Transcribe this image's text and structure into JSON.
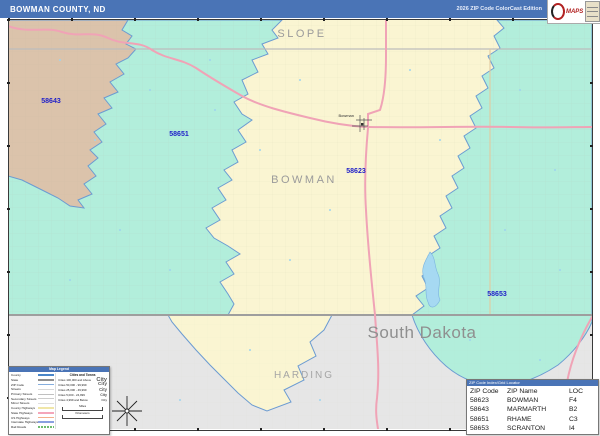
{
  "header": {
    "title": "BOWMAN COUNTY, ND",
    "edition": "2026 ZIP Code ColorCast Edition"
  },
  "logo": {
    "maps_text": "MAPS"
  },
  "map": {
    "labels": {
      "county_top": "SLOPE",
      "county_main": "BOWMAN",
      "county_bottom": "HARDING",
      "state": "South Dakota",
      "town": "Bowman"
    },
    "zip_labels": {
      "marmarth": "58643",
      "rhame": "58651",
      "bowman": "58623",
      "scranton": "58653"
    }
  },
  "legend": {
    "title": "Map Legend",
    "line_items": [
      "County",
      "State",
      "ZIP Code",
      "Streets",
      "Primary Streets",
      "Secondary Streets",
      "Minor Streets",
      "County Highways",
      "State Highways",
      "US Highways",
      "Interstate Highways",
      "Rail Roads"
    ],
    "cities_title": "Cities and Towns",
    "city_items": [
      {
        "label": "Cities 100,000 and Above",
        "sample": "City"
      },
      {
        "label": "Cities 50,000 - 99,999",
        "sample": "City"
      },
      {
        "label": "Cities 25,000 - 49,999",
        "sample": "City"
      },
      {
        "label": "Cities 5,000 - 24,999",
        "sample": "City"
      },
      {
        "label": "Cities 4,999 and Below",
        "sample": "City"
      }
    ],
    "scale": {
      "miles": "Miles",
      "kilometers": "Kilometers"
    }
  },
  "zip_table": {
    "title": "ZIP Code Index/Grid Locator",
    "columns": [
      "ZIP Code",
      "ZIP Name",
      "LOC"
    ],
    "rows": [
      [
        "58623",
        "BOWMAN",
        "F4"
      ],
      [
        "58643",
        "MARMARTH",
        "B2"
      ],
      [
        "58651",
        "RHAME",
        "C3"
      ],
      [
        "58653",
        "SCRANTON",
        "I4"
      ]
    ]
  },
  "colors": {
    "header_blue": "#4a74b6",
    "zip_58643_tan": "#dbc3ab",
    "zip_58651_teal": "#b2eedb",
    "zip_58623_yellow": "#faf5d2",
    "zip_58653_teal": "#b2eedb",
    "out_of_area_gray": "#e6e6e6",
    "highway_pink": "#f0a3b6",
    "zip_boundary_blue": "#6b9bd2",
    "zip_label_blue": "#2020c8",
    "water_blue": "#a6d9f2"
  }
}
